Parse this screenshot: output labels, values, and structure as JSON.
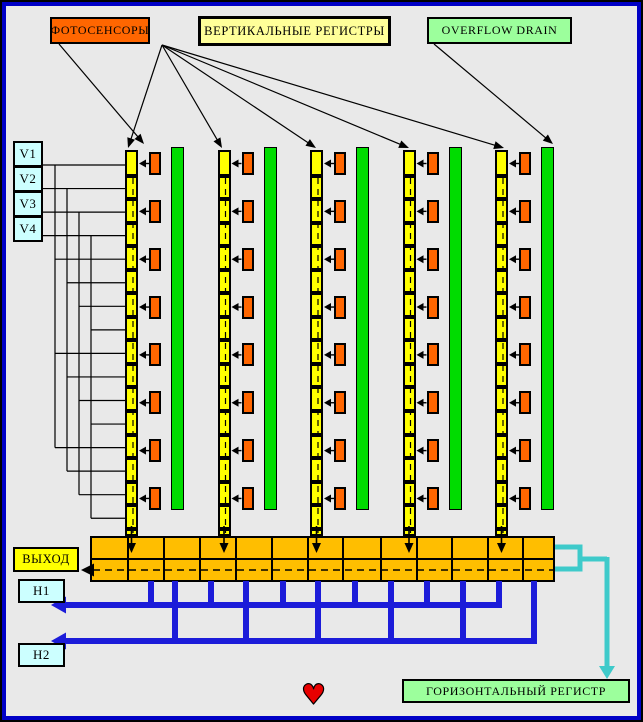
{
  "labels": {
    "photosensors": "ФОТОСЕНСОРЫ",
    "vertical_registers": "ВЕРТИКАЛЬНЫЕ РЕГИСТРЫ",
    "overflow_drain": "OVERFLOW DRAIN",
    "output": "ВЫХОД",
    "horizontal_register": "ГОРИЗОНТАЛЬНЫЙ РЕГИСТР",
    "vertical_phases": [
      "V1",
      "V2",
      "V3",
      "V4"
    ],
    "horizontal_phases": [
      "H1",
      "H2"
    ],
    "heart": "♥"
  },
  "colors": {
    "background": "#E9E9E9",
    "frame_blue": "#0000C6",
    "photosensor_orange": "#FF6600",
    "legend_yellow": "#FFFF99",
    "legend_green": "#9CFF9C",
    "phase_cyan": "#CCFFFF",
    "register_yellow": "#FFFF00",
    "drain_green": "#00DC00",
    "horizontal_register_amber": "#FFBE00",
    "clock_blue": "#1C1CD9",
    "output_cyan": "#3ECACA",
    "heart_red": "#E80000",
    "line_black": "#000000"
  },
  "structure": {
    "columns": 5,
    "photosensors_per_column": 8,
    "vertical_register_cells": 16,
    "horizontal_register_cells": 13,
    "vertical_phase_count": 4,
    "horizontal_phase_count": 2
  }
}
